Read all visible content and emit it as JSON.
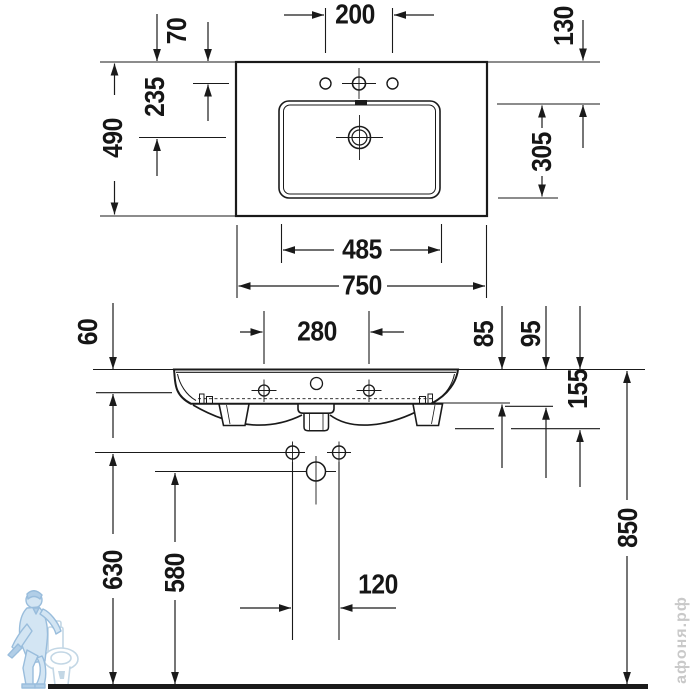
{
  "drawing": {
    "subject": "wall-mounted washbasin installation drawing",
    "line_color": "#1a1a1a",
    "background_color": "#ffffff"
  },
  "dimensions": {
    "top_view": {
      "faucet_hole_spacing": "200",
      "rear_to_faucet_holes": "70",
      "rear_to_drain_center": "235",
      "total_depth": "490",
      "rear_edge_to_basin": "130",
      "basin_inner_depth": "305",
      "basin_inner_width": "485",
      "total_width": "750"
    },
    "front_view": {
      "top_to_mounting_holes": "60",
      "mounting_hole_spacing": "280",
      "top_to_side_bottom": "85",
      "top_to_underside": "95",
      "top_to_drain_bottom": "155",
      "floor_to_fixing_holes": "630",
      "floor_to_siphon_line": "580",
      "fixing_hole_spacing": "120",
      "floor_to_rim": "850"
    }
  },
  "watermark": {
    "text": "афоня.рф",
    "logo": "plumber-with-toilet-logo",
    "logo_color": "#bad4ea",
    "text_color": "#c9c9c9"
  }
}
